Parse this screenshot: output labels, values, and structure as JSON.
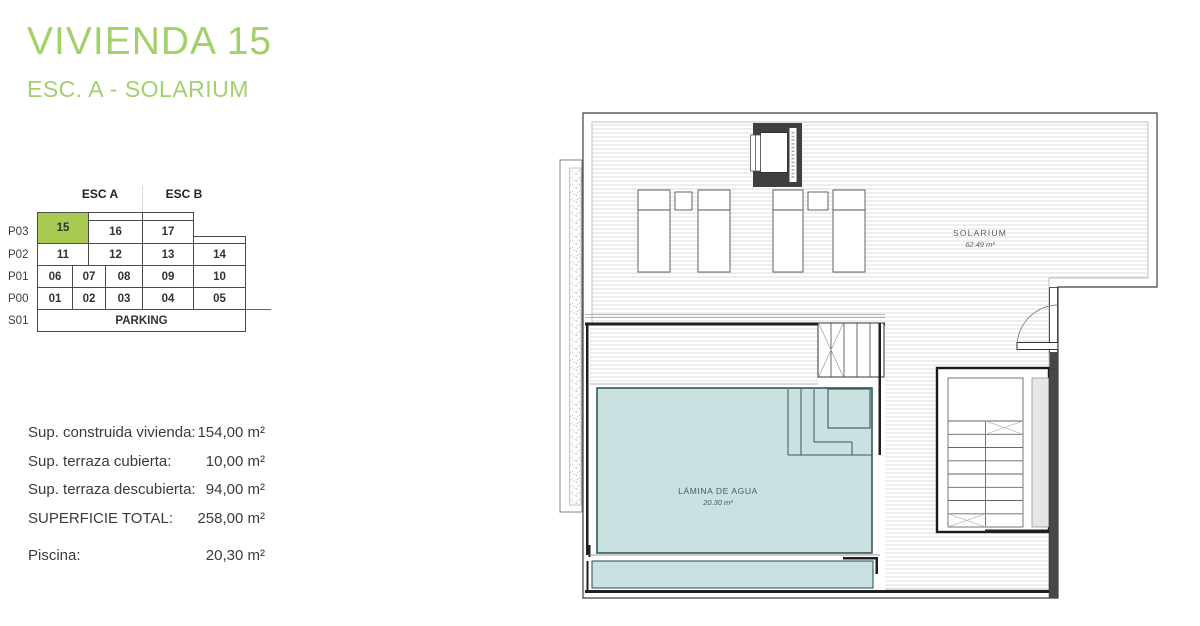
{
  "title": "VIVIENDA 15",
  "subtitle": "ESC. A - SOLARIUM",
  "colors": {
    "accent_green": "#a2d06b",
    "highlight_green": "#a8ca52",
    "pool_blue": "#c9e2e1",
    "pool_line": "#35585c",
    "wall_dark": "#474747",
    "hatch_gray": "#dcdcdc"
  },
  "building_grid": {
    "esc_a": "ESC A",
    "esc_b": "ESC B",
    "highlighted_unit": "15",
    "rows": [
      {
        "label": "P03",
        "cells": [
          "15",
          "16",
          "17"
        ]
      },
      {
        "label": "P02",
        "cells": [
          "11",
          "12",
          "13",
          "14"
        ]
      },
      {
        "label": "P01",
        "cells": [
          "06",
          "07",
          "08",
          "09",
          "10"
        ]
      },
      {
        "label": "P00",
        "cells": [
          "01",
          "02",
          "03",
          "04",
          "05"
        ]
      },
      {
        "label": "S01",
        "cells": [
          "PARKING"
        ]
      }
    ]
  },
  "surfaces": [
    {
      "label": "Sup. construida vivienda:",
      "value": "154,00 m²"
    },
    {
      "label": "Sup. terraza cubierta:",
      "value": "10,00 m²"
    },
    {
      "label": "Sup. terraza descubierta:",
      "value": "94,00 m²"
    },
    {
      "label": "SUPERFICIE TOTAL:",
      "value": "258,00 m²"
    },
    {
      "label": "Piscina:",
      "value": "20,30 m²"
    }
  ],
  "plan": {
    "solarium_label": "SOLARIUM",
    "solarium_area": "62.49 m²",
    "pool_label": "LÁMINA DE AGUA",
    "pool_area": "20.30 m²"
  }
}
